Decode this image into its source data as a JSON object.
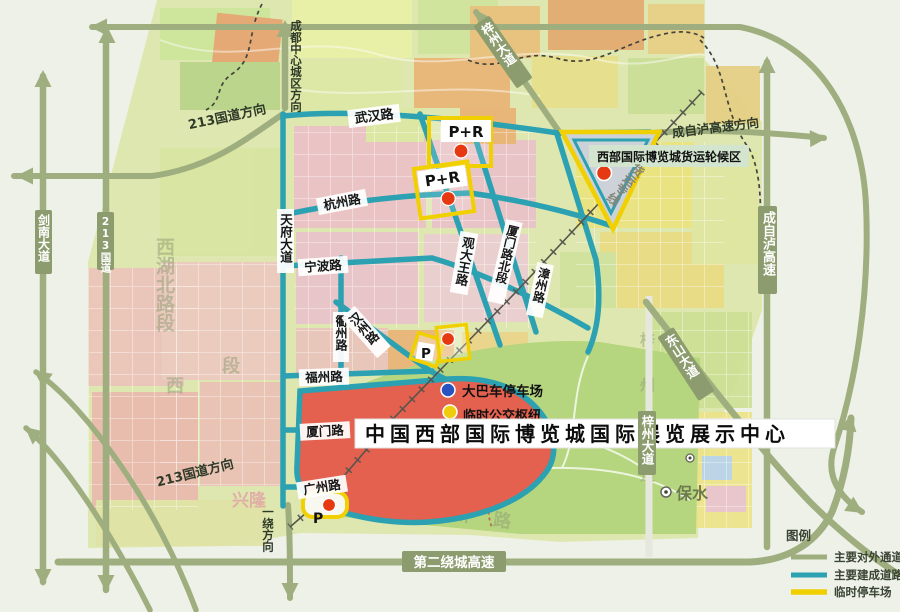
{
  "map": {
    "directions": {
      "chengdu_center": "成都中心城区方向",
      "g213_top": "213国道方向",
      "g213_bottom": "213国道方向",
      "czl_dir": "成自泸高速方向",
      "yirao": "一绕方向"
    },
    "roads": {
      "wuhan": "武汉路",
      "hangzhou": "杭州路",
      "ningbo": "宁波路",
      "tianfu": "天府大道",
      "quzhou": "衢州路",
      "hanzhou": "汉州路",
      "fuzhou": "福州路",
      "xiamen": "厦门路",
      "guangzhou": "广州路",
      "guandawang": "观大王路",
      "xiamen_north": "厦门路北段",
      "zhangzhou": "漳州路",
      "jiannan": "剑南大道",
      "g213": "213国道",
      "zizhou_top": "梓州大道",
      "zizhou": "梓州大道",
      "dongshan": "东山大道",
      "czl": "成自泸高速",
      "second_ring": "第二绕城高速",
      "freight_line": "货运专线"
    },
    "places": {
      "expo_banner": "中国西部国际博览城国际展览展示中心",
      "freight_area": "西部国际博览城货运轮候区",
      "bus_parking": "大巴车停车场",
      "transit_hub": "临时公交枢纽",
      "baoshui": "保水"
    },
    "markers": {
      "pr": "P+R",
      "p": "P"
    },
    "watermarks": {
      "left": "西湖北路段",
      "duan": "段",
      "xi": "西",
      "xinglong": "兴隆",
      "guangzhou_bg": "广州路",
      "zizhou_bg": "梓州大道"
    }
  },
  "legend": {
    "title": "图例",
    "items": [
      {
        "label": "主要对外通道",
        "color": "#9fae7e"
      },
      {
        "label": "主要建成道路",
        "color": "#2ba1b2"
      },
      {
        "label": "临时停车场",
        "color": "#f0d000"
      }
    ]
  },
  "colors": {
    "external_road": "#9fae7e",
    "built_road": "#2ba1b2",
    "temp_parking": "#f0d000",
    "expo_area": "#e4604f",
    "marker_dot": "#e63912"
  }
}
